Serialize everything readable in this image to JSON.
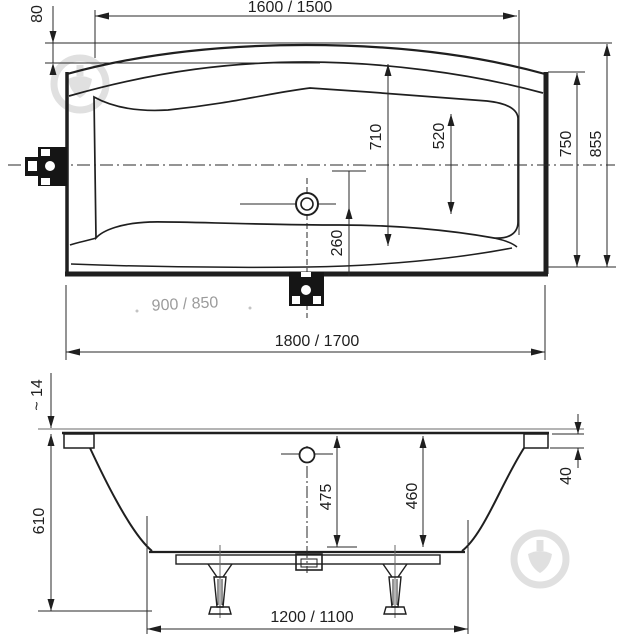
{
  "drawing": {
    "top_view": {
      "length_inner": "1600 / 1500",
      "rim_offset": "80",
      "width_overall": "855",
      "width_body": "750",
      "width_inner": "710",
      "width_basin": "520",
      "drain_to_edge": "260",
      "faded_note": "900 / 850",
      "length_overall": "1800 / 1700"
    },
    "side_view": {
      "rim_drop": "~ 14",
      "height_overall": "610",
      "depth_front": "475",
      "depth_back": "460",
      "rim_thickness": "40",
      "feet_spacing": "1200 / 1100"
    }
  },
  "colors": {
    "line": "#1f1f1f",
    "faded_dimension": "#9b9b9b",
    "watermark": "#c3c3c3",
    "bracket_fill": "#151515"
  }
}
